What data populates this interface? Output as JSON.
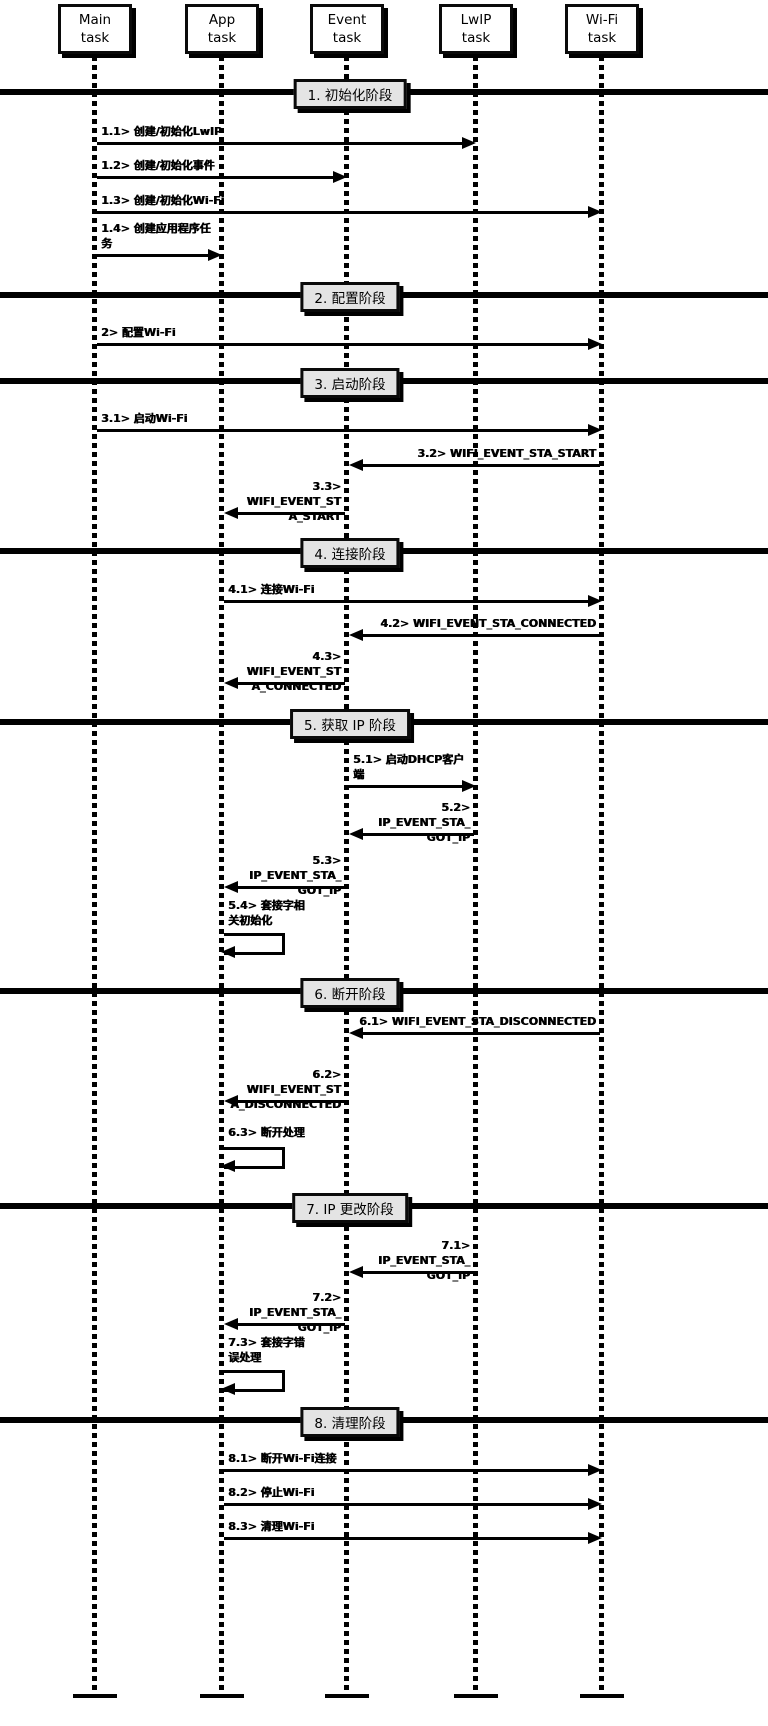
{
  "diagram": {
    "kind": "sequence-diagram",
    "background": "#ffffff",
    "line_color": "#000000",
    "divider_fill": "#e4e4e4",
    "tasks": [
      {
        "id": "main",
        "line1": "Main",
        "line2": "task"
      },
      {
        "id": "app",
        "line1": "App",
        "line2": "task"
      },
      {
        "id": "event",
        "line1": "Event",
        "line2": "task"
      },
      {
        "id": "lwip",
        "line1": "LwIP",
        "line2": "task"
      },
      {
        "id": "wifi",
        "line1": "Wi-Fi",
        "line2": "task"
      }
    ],
    "phases": [
      {
        "title": "1. 初始化阶段",
        "messages": [
          {
            "lines": [
              "1.1> 创建/初始化LwIP"
            ],
            "from": "Main task",
            "to": "LwIP task",
            "type": "message"
          },
          {
            "lines": [
              "1.2> 创建/初始化事件"
            ],
            "from": "Main task",
            "to": "Event task",
            "type": "message"
          },
          {
            "lines": [
              "1.3> 创建/初始化Wi-Fi"
            ],
            "from": "Main task",
            "to": "Wi-Fi task",
            "type": "message"
          },
          {
            "lines": [
              "1.4> 创建应用程序任",
              "务"
            ],
            "from": "Main task",
            "to": "App task",
            "type": "message"
          }
        ]
      },
      {
        "title": "2. 配置阶段",
        "messages": [
          {
            "lines": [
              "2> 配置Wi-Fi"
            ],
            "from": "Main task",
            "to": "Wi-Fi task",
            "type": "message"
          }
        ]
      },
      {
        "title": "3. 启动阶段",
        "messages": [
          {
            "lines": [
              "3.1> 启动Wi-Fi"
            ],
            "from": "Main task",
            "to": "Wi-Fi task",
            "type": "message"
          },
          {
            "lines": [
              "3.2> WIFI_EVENT_STA_START"
            ],
            "from": "Wi-Fi task",
            "to": "Event task",
            "type": "message"
          },
          {
            "lines": [
              "3.3> WIFI_EVENT_ST",
              "A_START"
            ],
            "from": "Event task",
            "to": "App task",
            "type": "message"
          }
        ]
      },
      {
        "title": "4. 连接阶段",
        "messages": [
          {
            "lines": [
              "4.1> 连接Wi-Fi"
            ],
            "from": "App task",
            "to": "Wi-Fi task",
            "type": "message"
          },
          {
            "lines": [
              "4.2> WIFI_EVENT_STA_CONNECTED"
            ],
            "from": "Wi-Fi task",
            "to": "Event task",
            "type": "message"
          },
          {
            "lines": [
              "4.3> WIFI_EVENT_ST",
              "A_CONNECTED"
            ],
            "from": "Event task",
            "to": "App task",
            "type": "message"
          }
        ]
      },
      {
        "title": "5. 获取 IP 阶段",
        "messages": [
          {
            "lines": [
              "5.1> 启动DHCP客户",
              "端"
            ],
            "from": "Event task",
            "to": "LwIP task",
            "type": "message"
          },
          {
            "lines": [
              "5.2> IP_EVENT_STA_",
              "GOT_IP"
            ],
            "from": "LwIP task",
            "to": "Event task",
            "type": "message"
          },
          {
            "lines": [
              "5.3> IP_EVENT_STA_",
              "GOT_IP"
            ],
            "from": "Event task",
            "to": "App task",
            "type": "message"
          },
          {
            "lines": [
              "5.4> 套接字相",
              "关初始化"
            ],
            "from": "App task",
            "to": "App task",
            "type": "self"
          }
        ]
      },
      {
        "title": "6. 断开阶段",
        "messages": [
          {
            "lines": [
              "6.1> WIFI_EVENT_STA_DISCONNECTED"
            ],
            "from": "Wi-Fi task",
            "to": "Event task",
            "type": "message"
          },
          {
            "lines": [
              "6.2> WIFI_EVENT_ST",
              "A_DISCONNECTED"
            ],
            "from": "Event task",
            "to": "App task",
            "type": "message"
          },
          {
            "lines": [
              "6.3> 断开处理"
            ],
            "from": "App task",
            "to": "App task",
            "type": "self"
          }
        ]
      },
      {
        "title": "7. IP 更改阶段",
        "messages": [
          {
            "lines": [
              "7.1> IP_EVENT_STA_",
              "GOT_IP"
            ],
            "from": "LwIP task",
            "to": "Event task",
            "type": "message"
          },
          {
            "lines": [
              "7.2> IP_EVENT_STA_",
              "GOT_IP"
            ],
            "from": "Event task",
            "to": "App task",
            "type": "message"
          },
          {
            "lines": [
              "7.3> 套接字错",
              "误处理"
            ],
            "from": "App task",
            "to": "App task",
            "type": "self"
          }
        ]
      },
      {
        "title": "8. 清理阶段",
        "messages": [
          {
            "lines": [
              "8.1> 断开Wi-Fi连接"
            ],
            "from": "App task",
            "to": "Wi-Fi task",
            "type": "message"
          },
          {
            "lines": [
              "8.2> 停止Wi-Fi"
            ],
            "from": "App task",
            "to": "Wi-Fi task",
            "type": "message"
          },
          {
            "lines": [
              "8.3> 清理Wi-Fi"
            ],
            "from": "App task",
            "to": "Wi-Fi task",
            "type": "message"
          }
        ]
      }
    ]
  }
}
